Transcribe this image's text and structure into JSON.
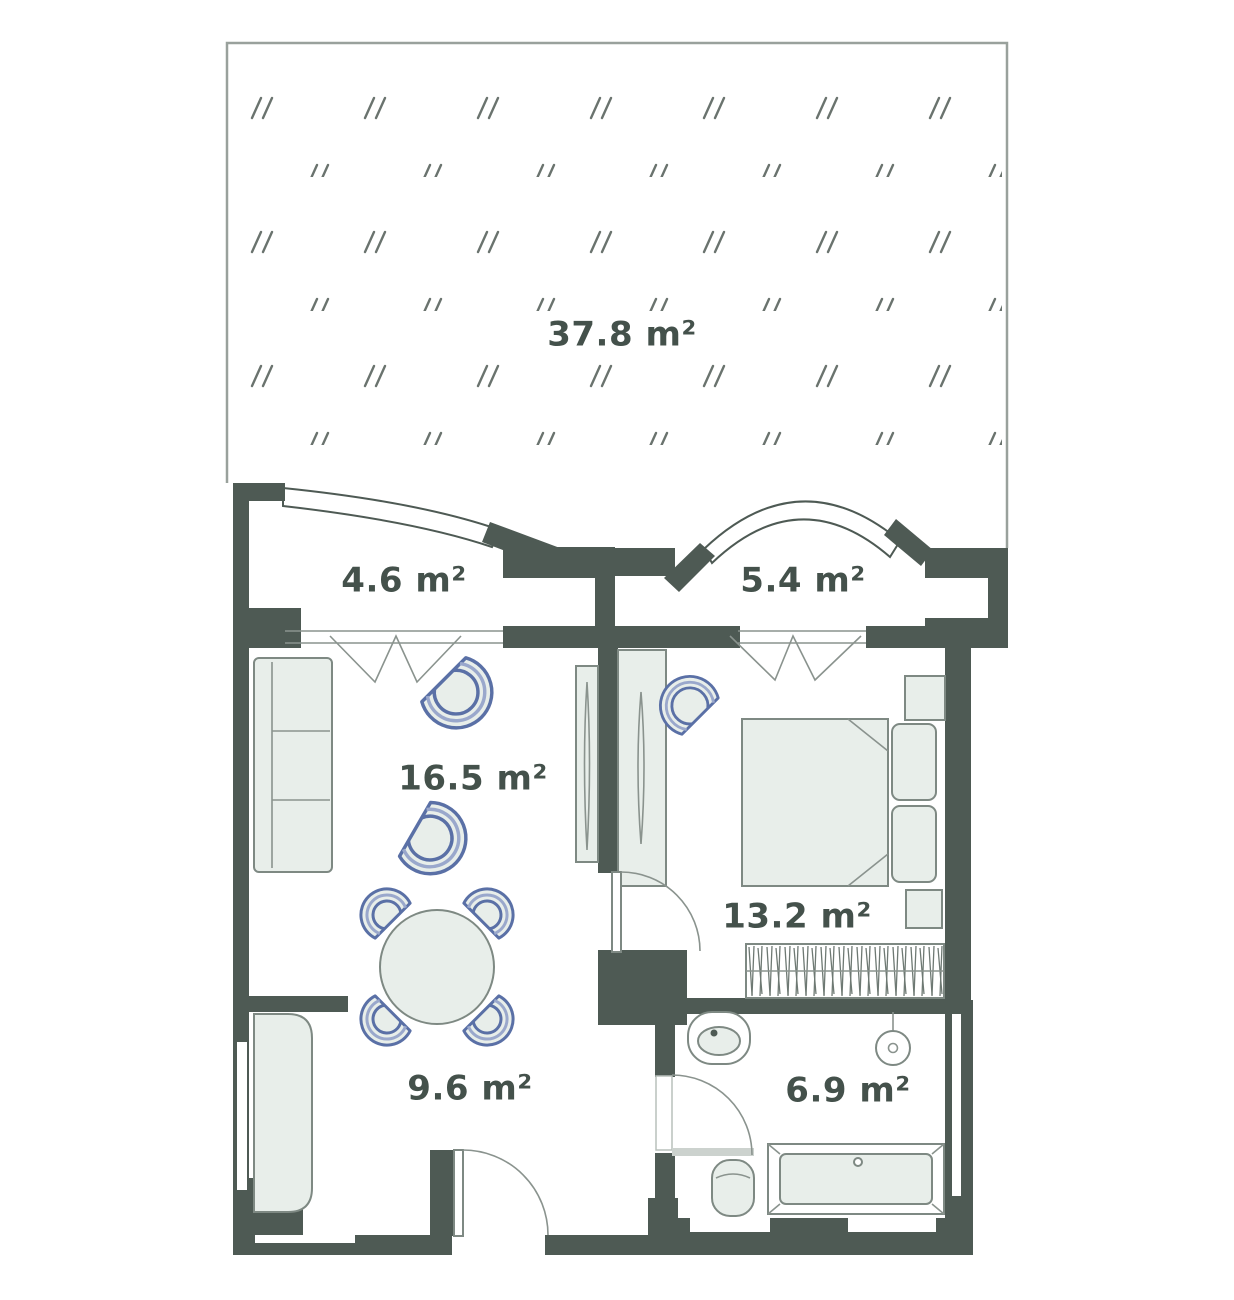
{
  "page": {
    "background": "#ffffff",
    "type": "apartment-floor-plan"
  },
  "colors": {
    "wall": "#4e5a54",
    "furniture_fill": "#e8eeea",
    "furniture_stroke": "#7e8983",
    "accent_blue": "#5a70a6",
    "accent_blue_light": "#9aa8cc",
    "hatch_mark": "#6a736e",
    "label_text": "#44514b",
    "garden_boundary": "#99a19c"
  },
  "rooms": {
    "garden": {
      "area_label": "37.8 m²"
    },
    "balcony_left": {
      "area_label": "4.6 m²"
    },
    "balcony_right": {
      "area_label": "5.4 m²"
    },
    "living_room": {
      "area_label": "16.5 m²"
    },
    "bedroom": {
      "area_label": "13.2 m²"
    },
    "kitchen": {
      "area_label": "9.6 m²"
    },
    "bathroom": {
      "area_label": "6.9 m²"
    }
  },
  "furniture_symbols": [
    "sofa",
    "armchair",
    "dining-table",
    "dining-chair",
    "wardrobe",
    "mirror",
    "double-bed",
    "pillow",
    "nightstand",
    "clothes-rail",
    "kitchen-counter",
    "sink",
    "shower",
    "toilet",
    "bathtub",
    "door",
    "window",
    "curved-railing"
  ]
}
